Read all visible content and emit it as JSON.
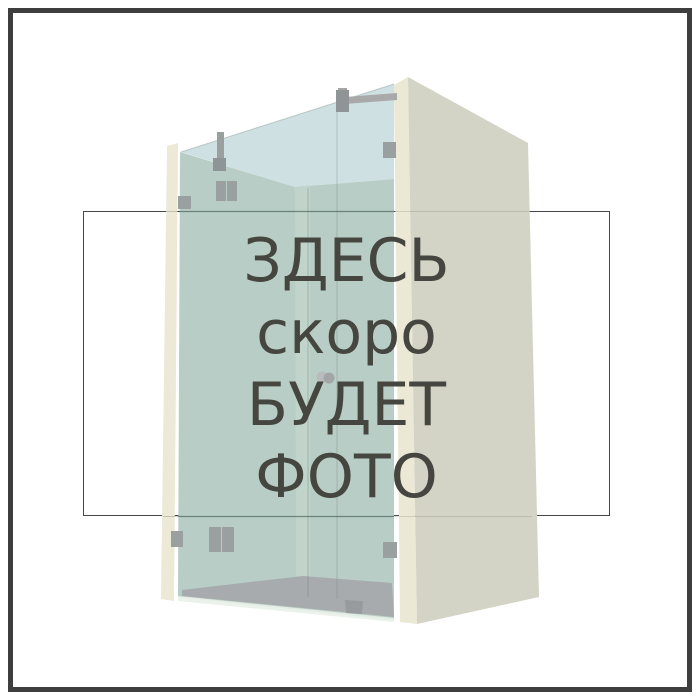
{
  "placeholder": {
    "lines": [
      "ЗДЕСЬ",
      "скоро",
      "БУДЕТ",
      "ФОТО"
    ]
  },
  "illustration": {
    "name": "glass-shower-enclosure-render",
    "description": "3D render of a frameless glass shower enclosure between two walls with metal clamps, support bar and round door knob"
  },
  "colors": {
    "text": "#45463f",
    "outer_frame_border": "#3e3e3e",
    "placeholder_box_border": "#474747",
    "glass_front": "#b7cdc5",
    "glass_back_top": "#cfe0e2",
    "glass_seam_band": "#c3d6cc",
    "right_wall_face": "#d3d4c6",
    "right_wall_edge": "#ebe8d5",
    "left_wall_edge": "#ece9d7",
    "floor": "#a8abad",
    "glass_bottom_bevel": "#e9efe9",
    "hardware": "#9aa0a0"
  }
}
